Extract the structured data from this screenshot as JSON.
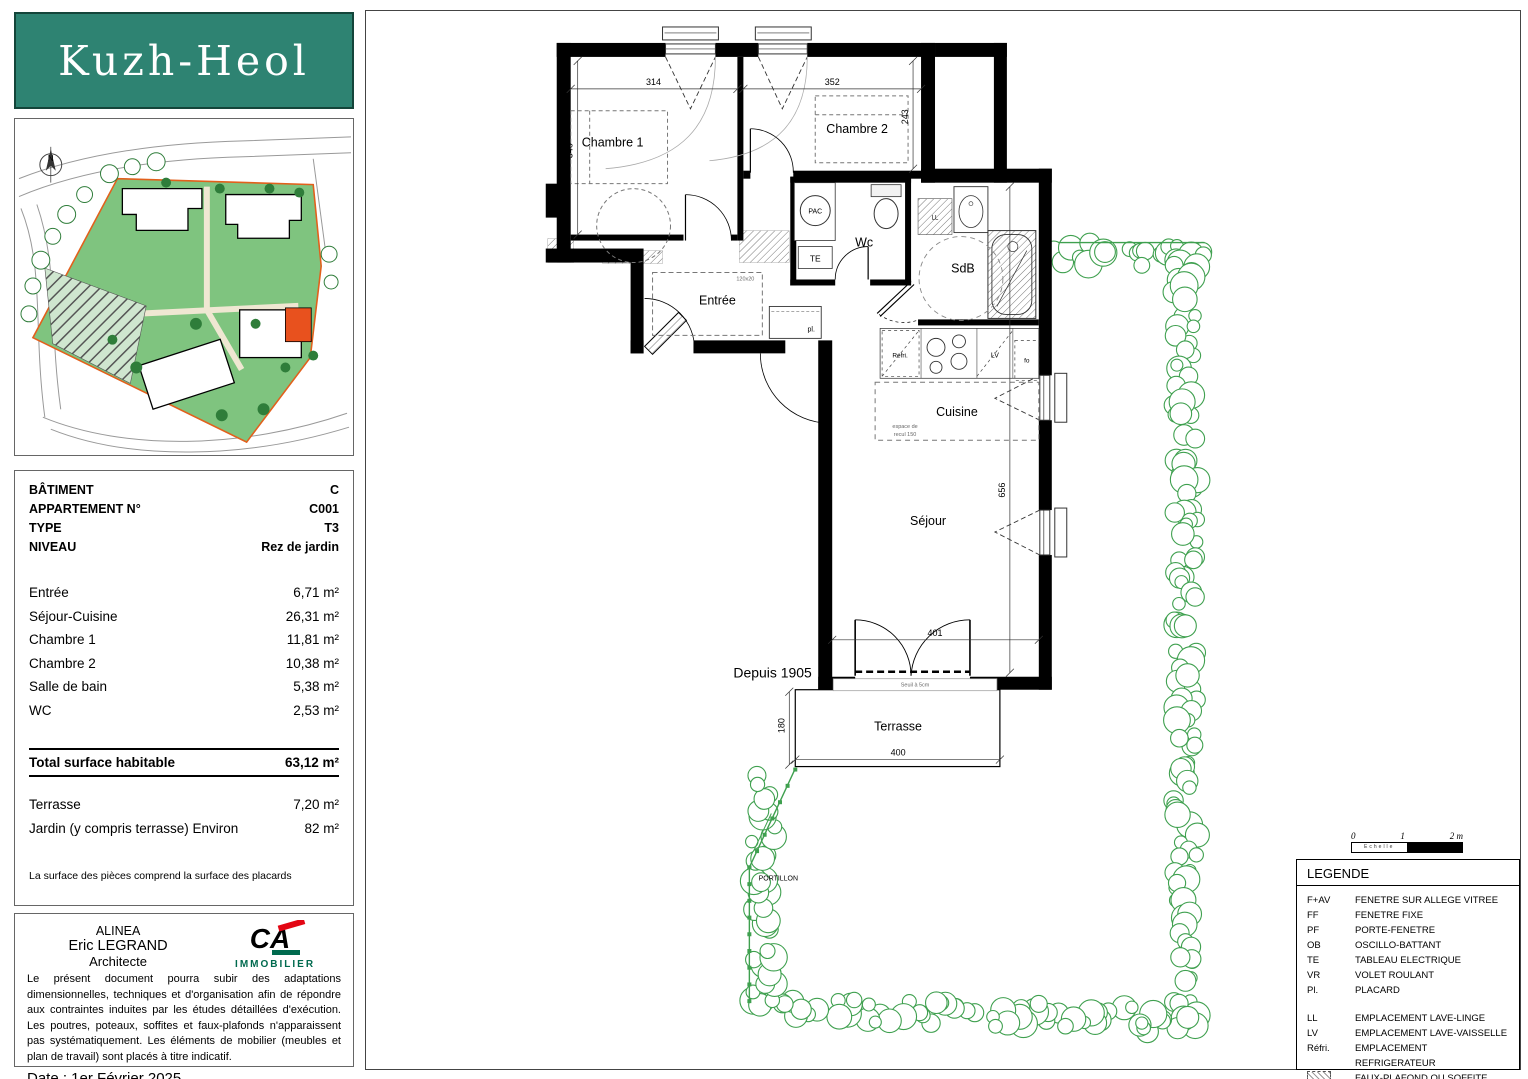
{
  "colors": {
    "teal": "#2E8372",
    "ca_green": "#006A4E",
    "ca_red": "#E30613",
    "site_green": "#7FC47F",
    "boundary_orange": "#E2601C",
    "unit_orange": "#E8511E",
    "hedge_green": "#3FA04F"
  },
  "logo": {
    "title": "Kuzh-Heol"
  },
  "site_plan": {
    "compass": "N"
  },
  "info_panel": {
    "header": [
      {
        "label": "BÂTIMENT",
        "value": "C"
      },
      {
        "label": "APPARTEMENT N°",
        "value": "C001"
      },
      {
        "label": "TYPE",
        "value": "T3"
      },
      {
        "label": "NIVEAU",
        "value": "Rez de jardin"
      }
    ],
    "areas": [
      {
        "label": "Entrée",
        "value": "6,71 m²"
      },
      {
        "label": "Séjour-Cuisine",
        "value": "26,31 m²"
      },
      {
        "label": "Chambre 1",
        "value": "11,81 m²"
      },
      {
        "label": "Chambre 2",
        "value": "10,38 m²"
      },
      {
        "label": "Salle de bain",
        "value": "5,38 m²"
      },
      {
        "label": "WC",
        "value": "2,53 m²"
      }
    ],
    "total": {
      "label": "Total surface habitable",
      "value": "63,12 m²"
    },
    "extras": [
      {
        "label": "Terrasse",
        "value": "7,20 m²"
      },
      {
        "label": "Jardin (y compris terrasse) Environ",
        "value": "82 m²"
      }
    ],
    "footnote": "La surface des pièces comprend la surface des placards"
  },
  "architect_panel": {
    "firm": "ALINEA",
    "name": "Eric LEGRAND",
    "role": "Architecte",
    "brand_initials": "CA",
    "brand": "IMMOBILIER",
    "disclaimer": "Le présent document pourra subir des adaptations dimensionnelles, techniques et d'organisation afin de répondre aux contraintes induites par les études détaillées d'exécution. Les poutres, poteaux, soffites et faux-plafonds n'apparaissent pas systématiquement. Les éléments de mobilier (meubles et plan de travail) sont placés à titre indicatif.",
    "date": "Date : 1er Février 2025"
  },
  "floor_plan": {
    "rooms": {
      "chambre1": "Chambre 1",
      "chambre2": "Chambre 2",
      "entree": "Entrée",
      "wc": "Wc",
      "sdb": "SdB",
      "cuisine": "Cuisine",
      "sejour": "Séjour",
      "terrasse": "Terrasse"
    },
    "equipment": {
      "pac": "PAC",
      "te": "TE",
      "pl": "pl.",
      "refri": "Réfri.",
      "lv": "LV",
      "fo": "fo",
      "ll": "LL"
    },
    "notes": {
      "placard_size": "120x20",
      "espace_1": "espace de",
      "espace_2": "recul 150",
      "seuil": "Seuil à 5cm",
      "portillon": "PORTILLON",
      "watermark": "Depuis 1905"
    },
    "dims": {
      "chambre1_w": "314",
      "chambre2_w": "352",
      "chambre1_h": "346",
      "chambre2_h": "243",
      "sejour_h": "656",
      "baie_w": "401",
      "terrasse_h": "180",
      "terrasse_w": "400"
    }
  },
  "scale_bar": {
    "t0": "0",
    "t1": "1",
    "t2": "2 m",
    "label": "Echelle"
  },
  "legend": {
    "title": "LEGENDE",
    "group1": [
      {
        "abbr": "F+AV",
        "desc": "FENETRE SUR ALLEGE VITREE"
      },
      {
        "abbr": "FF",
        "desc": "FENETRE FIXE"
      },
      {
        "abbr": "PF",
        "desc": "PORTE-FENETRE"
      },
      {
        "abbr": "OB",
        "desc": "OSCILLO-BATTANT"
      },
      {
        "abbr": "TE",
        "desc": "TABLEAU ELECTRIQUE"
      },
      {
        "abbr": "VR",
        "desc": "VOLET ROULANT"
      },
      {
        "abbr": "Pl.",
        "desc": "PLACARD"
      }
    ],
    "group2": [
      {
        "abbr": "LL",
        "desc": "EMPLACEMENT LAVE-LINGE"
      },
      {
        "abbr": "LV",
        "desc": "EMPLACEMENT LAVE-VAISSELLE"
      },
      {
        "abbr": "Réfri.",
        "desc": "EMPLACEMENT REFRIGERATEUR"
      }
    ],
    "faux": {
      "desc": "FAUX-PLAFOND OU SOFFITE"
    }
  }
}
